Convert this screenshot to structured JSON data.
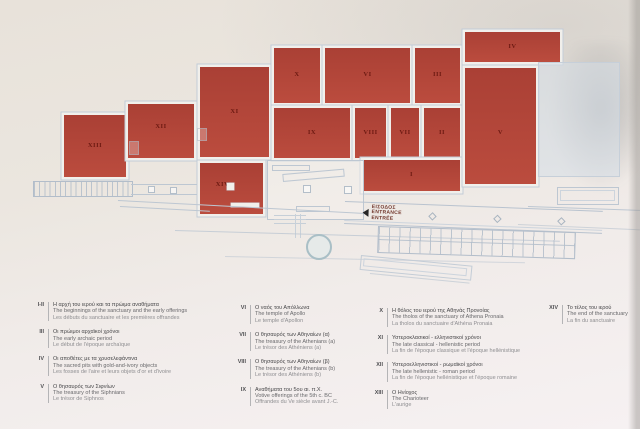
{
  "map": {
    "room_labels": {
      "i": "I",
      "ii": "II",
      "iii": "III",
      "iv": "IV",
      "v": "V",
      "vi": "VI",
      "vii": "VII",
      "viii": "VIII",
      "ix": "IX",
      "x": "X",
      "xi": "XI",
      "xii": "XII",
      "xiii": "XIII",
      "xiv": "XIV"
    },
    "entrance": {
      "greek": "ΕΙΣΟΔΟΣ",
      "english": "ENTRANCE",
      "french": "ENTRÉE"
    },
    "colors": {
      "room_fill": "#bb4c3e",
      "room_fill_dark": "#aa4035",
      "room_outline": "#c3ccd7",
      "wall_white": "#f1efeb",
      "room_label": "#6d1a12",
      "plan_line": "#bdc7d2",
      "entrance_text": "#70352a",
      "circle_stroke": "#a9bfc6"
    }
  },
  "legend": {
    "columns": [
      {
        "entries": [
          {
            "num": "I-II",
            "el": "Η αρχή του ιερού και τα πρώιμα αναθήματα",
            "en": "The beginnings of the sanctuary and the early offerings",
            "fr": "Les débuts du sanctuaire et les premières offrandes"
          },
          {
            "num": "III",
            "el": "Οι πρώιμοι αρχαϊκοί χρόνοι",
            "en": "The early archaic period",
            "fr": "Le début de l'époque archaïque"
          },
          {
            "num": "IV",
            "el": "Οι αποθέτες με τα χρυσελεφάντινα",
            "en": "The sacred pits with gold-and-ivory objects",
            "fr": "Les fosses de l'aire et leurs objets d'or et d'ivoire"
          },
          {
            "num": "V",
            "el": "Ο θησαυρός των Σιφνίων",
            "en": "The treasury of the Siphnians",
            "fr": "Le trésor de Siphnos"
          }
        ]
      },
      {
        "entries": [
          {
            "num": "VI",
            "el": "Ο ναός του Απόλλωνα",
            "en": "The temple of Apollo",
            "fr": "Le temple d'Apollon"
          },
          {
            "num": "VII",
            "el": "Ο θησαυρός των Αθηναίων (α)",
            "en": "The treasury of the Athenians (a)",
            "fr": "Le trésor des Athéniens (a)"
          },
          {
            "num": "VIII",
            "el": "Ο θησαυρός των Αθηναίων (β)",
            "en": "The treasury of the Athenians (b)",
            "fr": "Le trésor des Athéniens (b)"
          },
          {
            "num": "IX",
            "el": "Αναθήματα του 5ου αι. π.Χ.",
            "en": "Votive offerings of the 5th c. BC",
            "fr": "Offrandes du Ve siècle avant J.-C."
          }
        ]
      },
      {
        "entries": [
          {
            "num": "X",
            "el": "Η θόλος του ιερού της Αθηνάς Προνοίας",
            "en": "The tholos of the sanctuary of Athena Pronaia",
            "fr": "La tholos du sanctuaire d'Athéna Pronaia"
          },
          {
            "num": "XI",
            "el": "Υστεροκλασικοί - ελληνιστικοί χρόνοι",
            "en": "The late classical - hellenistic period",
            "fr": "La fin de l'époque classique et l'époque hellénistique"
          },
          {
            "num": "XII",
            "el": "Υστεροελληνιστικοί - ρωμαϊκοί χρόνοι",
            "en": "The late hellenistic - roman period",
            "fr": "La fin de l'époque hellénistique et l'époque romaine"
          },
          {
            "num": "XIII",
            "el": "Ο Ηνίοχος",
            "en": "The Charioteer",
            "fr": "L'aurige"
          }
        ]
      },
      {
        "entries": [
          {
            "num": "XIV",
            "el": "Το τέλος του ιερού",
            "en": "The end of the sanctuary",
            "fr": "La fin du sanctuaire"
          }
        ]
      }
    ]
  }
}
